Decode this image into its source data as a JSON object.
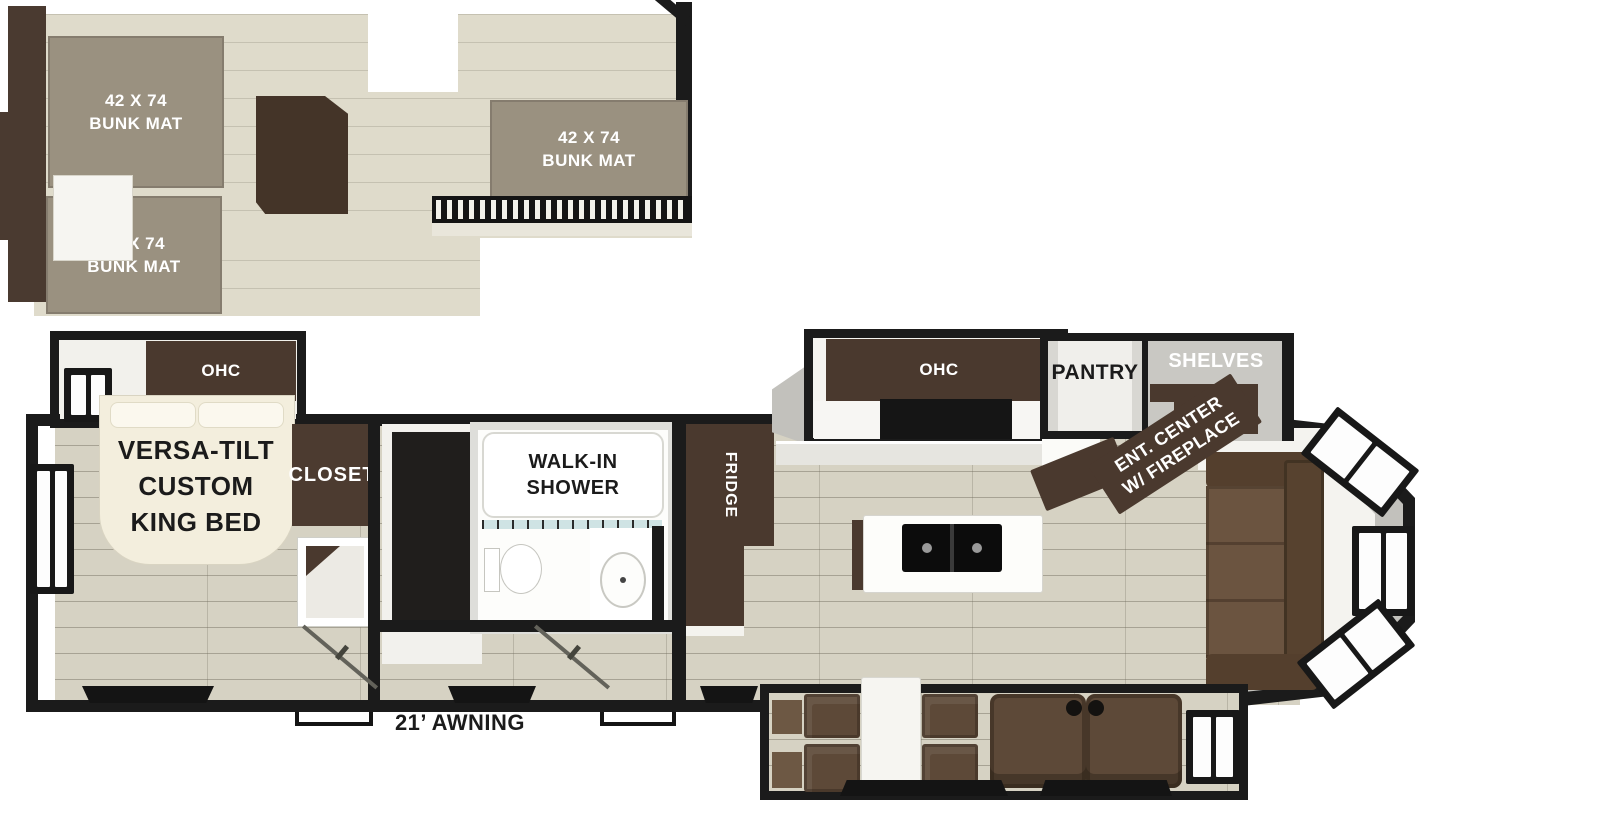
{
  "plan": {
    "title": "RV floor plan with rear living, middle kitchen, walk-in shower, front king bedroom and loft",
    "loft": {
      "bunk_mat_front_top": {
        "line1": "42 X 74",
        "line2": "BUNK MAT"
      },
      "bunk_mat_front_bottom": {
        "line1": "42 X 74",
        "line2": "BUNK MAT"
      },
      "bunk_mat_rear": {
        "line1": "42 X 74",
        "line2": "BUNK MAT"
      }
    },
    "bedroom": {
      "ohc": "OHC",
      "bed": {
        "line1": "VERSA-TILT",
        "line2": "CUSTOM",
        "line3": "KING BED"
      },
      "closet": "CLOSET"
    },
    "bathroom": {
      "shower": {
        "line1": "WALK-IN",
        "line2": "SHOWER"
      }
    },
    "kitchen": {
      "fridge": "FRIDGE",
      "ohc": "OHC",
      "pantry": "PANTRY",
      "shelves": "SHELVES",
      "ent_center": {
        "line1": "ENT. CENTER",
        "line2": "W/ FIREPLACE"
      }
    },
    "exterior": {
      "awning": "21’ AWNING"
    },
    "colors": {
      "wall": "#1b1b1b",
      "loft_floor": "#dfdbcb",
      "wood_floor": "#d6d2c3",
      "bunk_mat": "#9a9180",
      "cabinet": "#4a392e",
      "closet": "#4c3b30",
      "bed": "#f3eedd",
      "sofa": "#6b5440",
      "seat": "#5d4938",
      "gray_wall": "#c2c1bc",
      "white": "#ffffff"
    }
  }
}
